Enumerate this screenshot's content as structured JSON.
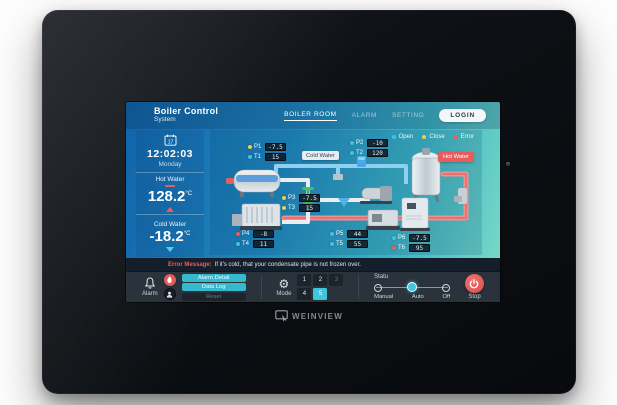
{
  "brand": {
    "logo_text": "WEINVIEW"
  },
  "header": {
    "title": "Boiler Control",
    "subtitle": "System",
    "nav": [
      {
        "label": "BOILER ROOM",
        "active": true
      },
      {
        "label": "ALARM",
        "active": false
      },
      {
        "label": "SETTING",
        "active": false
      }
    ],
    "login_label": "LOGIN"
  },
  "sidebar": {
    "calendar_day": "17",
    "time": "12:02:03",
    "weekday": "Monday",
    "hot_water": {
      "label": "Hot Water",
      "value": "128.2",
      "unit": "°C"
    },
    "cold_water": {
      "label": "Cold Water",
      "value": "-18.2",
      "unit": "°C"
    }
  },
  "legend": {
    "items": [
      {
        "label": "Open",
        "color": "#3fc6df"
      },
      {
        "label": "Close",
        "color": "#e8d24a"
      },
      {
        "label": "Error",
        "color": "#ef5a5a"
      }
    ]
  },
  "diagram": {
    "hot_water_badge": "Hot Water",
    "cold_water_badge": "Cold Water",
    "sensor_groups": [
      {
        "rows": [
          {
            "name": "P1",
            "value": "-7.5",
            "color": "#e8d24a"
          },
          {
            "name": "T1",
            "value": "15",
            "color": "#3fc6df"
          }
        ]
      },
      {
        "rows": [
          {
            "name": "P2",
            "value": "-10",
            "color": "#3fc6df"
          },
          {
            "name": "T2",
            "value": "120",
            "color": "#3fc6df"
          }
        ]
      },
      {
        "rows": [
          {
            "name": "P3",
            "value": "-7.5",
            "color": "#e8d24a"
          },
          {
            "name": "T3",
            "value": "15",
            "color": "#e8d24a"
          }
        ]
      },
      {
        "rows": [
          {
            "name": "P4",
            "value": "-8",
            "color": "#ef5a5a"
          },
          {
            "name": "T4",
            "value": "11",
            "color": "#3fc6df"
          }
        ]
      },
      {
        "rows": [
          {
            "name": "P5",
            "value": "44",
            "color": "#3fc6df"
          },
          {
            "name": "T5",
            "value": "55",
            "color": "#3fc6df"
          }
        ]
      },
      {
        "rows": [
          {
            "name": "P6",
            "value": "-7.5",
            "color": "#3fc6df"
          },
          {
            "name": "T6",
            "value": "95",
            "color": "#ef5a5a"
          }
        ]
      }
    ]
  },
  "alert": {
    "prefix": "Error Message:",
    "message": "If it's cold, that your condensate pipe is not frozen over."
  },
  "controls": {
    "alarm": {
      "label": "Alarm",
      "detail_button": "Alarm Detail",
      "log_button": "Data Log",
      "reset_button": "Reset"
    },
    "mode": {
      "label": "Mode",
      "keys": [
        "1",
        "2",
        "3",
        "4",
        "5"
      ],
      "active_key": "5"
    },
    "status": {
      "label": "Statu",
      "options": [
        "Manual",
        "Auto",
        "Off"
      ],
      "selected": "Auto"
    },
    "stop_label": "Stop"
  },
  "colors": {
    "accent_cyan": "#3fc6df",
    "alert_red": "#e85c5c",
    "warn_yellow": "#e8d24a"
  }
}
